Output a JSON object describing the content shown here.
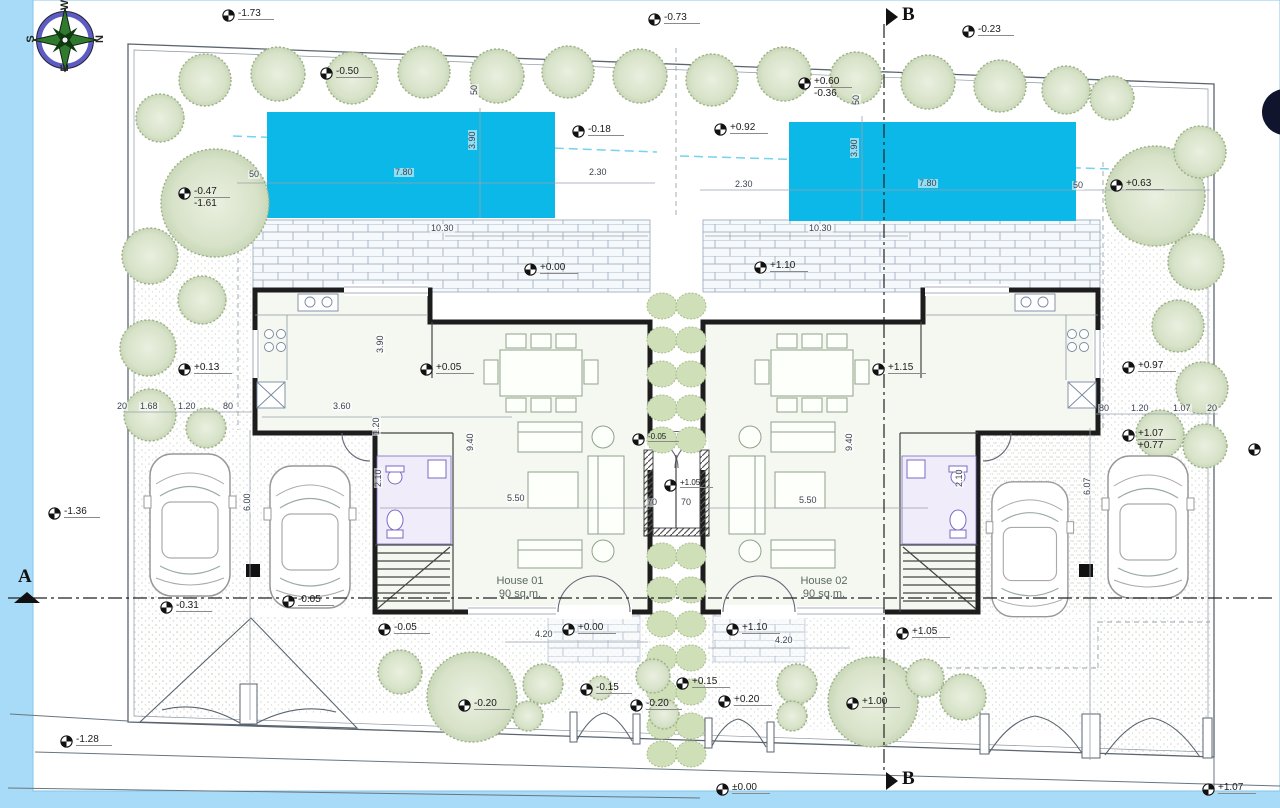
{
  "colors": {
    "background": "#a7dbf7",
    "sheet": "#ffffff",
    "pool": "#0cb8e8",
    "tree_fill": "#d7e2c8",
    "hedge": "#cfe0b8",
    "bath_accent": "#7a6ac4",
    "wall": "#1d1d1d"
  },
  "compass": {
    "top": "W",
    "right": "N",
    "left": "S",
    "bottom": "E"
  },
  "sections": {
    "a": "A",
    "b_top": "B",
    "b_bottom": "B"
  },
  "houses": [
    {
      "name": "House 01",
      "area": "90 sq.m."
    },
    {
      "name": "House 02",
      "area": "90 sq.m."
    }
  ],
  "levels": [
    {
      "label": "-1.73",
      "x": 222,
      "y": 8
    },
    {
      "label": "-0.73",
      "x": 648,
      "y": 12
    },
    {
      "label": "-0.23",
      "x": 962,
      "y": 24
    },
    {
      "label": "-0.50",
      "x": 320,
      "y": 66
    },
    {
      "label": "+0.60",
      "label2": "-0.36",
      "x": 798,
      "y": 76
    },
    {
      "label": "-0.18",
      "x": 572,
      "y": 124
    },
    {
      "label": "+0.92",
      "x": 714,
      "y": 122
    },
    {
      "label": "-0.47",
      "label2": "-1.61",
      "x": 178,
      "y": 186
    },
    {
      "label": "+0.63",
      "x": 1110,
      "y": 178
    },
    {
      "label": "+0.00",
      "x": 524,
      "y": 262
    },
    {
      "label": "+1.10",
      "x": 754,
      "y": 260
    },
    {
      "label": "+0.13",
      "x": 178,
      "y": 362
    },
    {
      "label": "+0.05",
      "x": 420,
      "y": 362
    },
    {
      "label": "+1.15",
      "x": 872,
      "y": 362
    },
    {
      "label": "+0.97",
      "x": 1122,
      "y": 360
    },
    {
      "label": "+1.07",
      "label2": "+0.77",
      "x": 1122,
      "y": 428
    },
    {
      "label": "-1.36",
      "x": 48,
      "y": 506
    },
    {
      "label": "-0.31",
      "x": 160,
      "y": 600
    },
    {
      "label": "-0.05",
      "x": 282,
      "y": 594
    },
    {
      "label": "-0.05",
      "x": 378,
      "y": 622
    },
    {
      "label": "+0.00",
      "x": 562,
      "y": 622
    },
    {
      "label": "+1.10",
      "x": 726,
      "y": 622
    },
    {
      "label": "+1.05",
      "x": 896,
      "y": 626
    },
    {
      "label": "-0.20",
      "x": 458,
      "y": 698
    },
    {
      "label": "-0.15",
      "x": 580,
      "y": 682
    },
    {
      "label": "-0.20",
      "x": 630,
      "y": 698
    },
    {
      "label": "+0.15",
      "x": 676,
      "y": 676
    },
    {
      "label": "+0.20",
      "x": 718,
      "y": 694
    },
    {
      "label": "+1.00",
      "x": 846,
      "y": 696
    },
    {
      "label": "-1.28",
      "x": 60,
      "y": 734
    },
    {
      "label": "±0.00",
      "x": 716,
      "y": 782
    },
    {
      "label": "+1.07",
      "x": 1202,
      "y": 782
    },
    {
      "label": "-0.05",
      "x": 632,
      "y": 432,
      "small": true
    },
    {
      "label": "+1.05",
      "x": 664,
      "y": 478,
      "small": true
    },
    {
      "label": "",
      "x": 1248,
      "y": 442
    }
  ],
  "dimensions": [
    {
      "label": "50",
      "x": 248,
      "y": 170
    },
    {
      "label": "7.80",
      "x": 394,
      "y": 168
    },
    {
      "label": "2.30",
      "x": 588,
      "y": 168
    },
    {
      "label": "2.30",
      "x": 734,
      "y": 180
    },
    {
      "label": "7.80",
      "x": 918,
      "y": 179
    },
    {
      "label": "50",
      "x": 1072,
      "y": 181
    },
    {
      "label": "10.30",
      "x": 430,
      "y": 224
    },
    {
      "label": "10.30",
      "x": 808,
      "y": 224
    },
    {
      "label": "3.60",
      "x": 332,
      "y": 402
    },
    {
      "label": "5.50",
      "x": 506,
      "y": 494
    },
    {
      "label": "5.50",
      "x": 798,
      "y": 496
    },
    {
      "label": "4.20",
      "x": 534,
      "y": 630
    },
    {
      "label": "4.20",
      "x": 774,
      "y": 636
    },
    {
      "label": "70",
      "x": 646,
      "y": 498
    },
    {
      "label": "70",
      "x": 680,
      "y": 498
    },
    {
      "label": "20",
      "x": 116,
      "y": 402
    },
    {
      "label": "1.68",
      "x": 139,
      "y": 402
    },
    {
      "label": "1.20",
      "x": 177,
      "y": 402
    },
    {
      "label": "80",
      "x": 222,
      "y": 402
    },
    {
      "label": "80",
      "x": 1098,
      "y": 404
    },
    {
      "label": "1.20",
      "x": 1130,
      "y": 404
    },
    {
      "label": "1.07",
      "x": 1172,
      "y": 404
    },
    {
      "label": "20",
      "x": 1206,
      "y": 404
    },
    {
      "label": "3.90",
      "x": 468,
      "y": 150,
      "rot": true
    },
    {
      "label": "3.90",
      "x": 850,
      "y": 158,
      "rot": true
    },
    {
      "label": "50",
      "x": 470,
      "y": 96,
      "rot": true
    },
    {
      "label": "50",
      "x": 852,
      "y": 106,
      "rot": true
    },
    {
      "label": "6.00",
      "x": 243,
      "y": 512,
      "rot": true
    },
    {
      "label": "6.07",
      "x": 1083,
      "y": 496,
      "rot": true
    },
    {
      "label": "9.40",
      "x": 466,
      "y": 452,
      "rot": true
    },
    {
      "label": "9.40",
      "x": 845,
      "y": 452,
      "rot": true
    },
    {
      "label": "3.90",
      "x": 376,
      "y": 354,
      "rot": true
    },
    {
      "label": "2.10",
      "x": 374,
      "y": 488,
      "rot": true
    },
    {
      "label": "2.10",
      "x": 955,
      "y": 488,
      "rot": true
    },
    {
      "label": "1.20",
      "x": 372,
      "y": 436,
      "rot": true
    }
  ]
}
